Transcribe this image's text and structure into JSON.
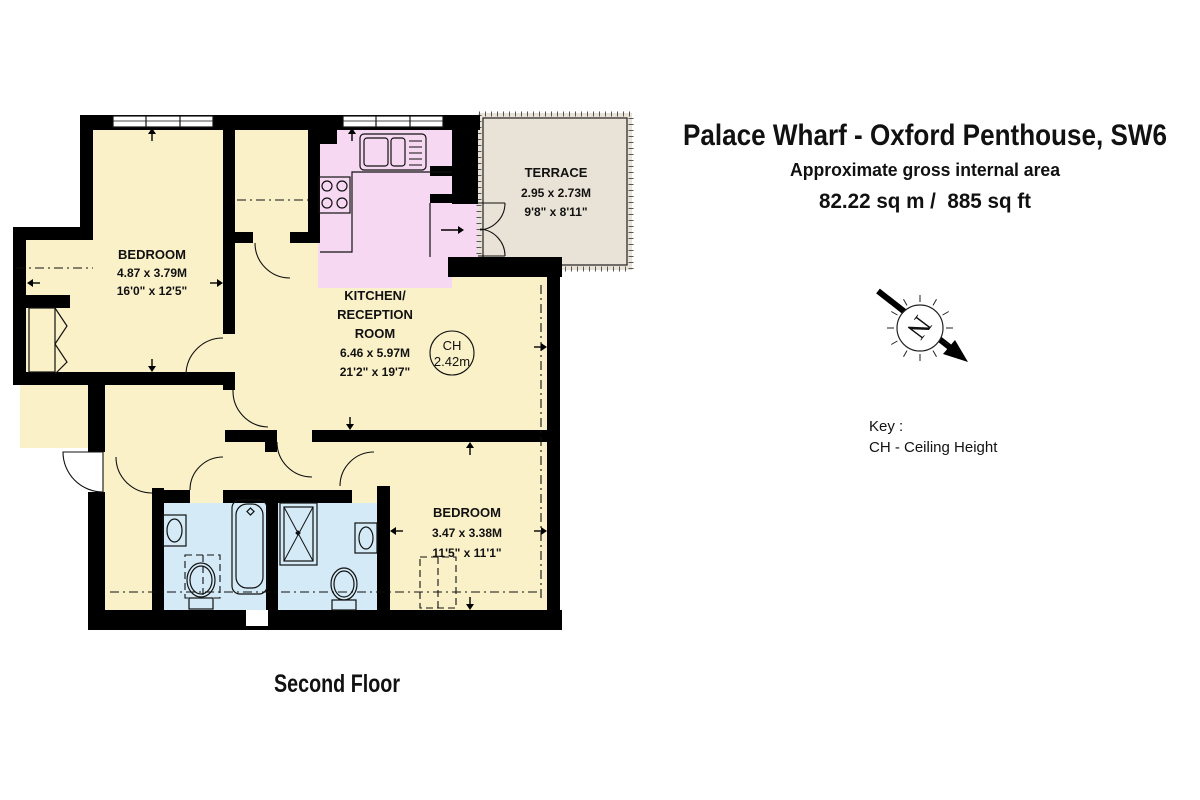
{
  "header": {
    "title": "Palace Wharf - Oxford Penthouse, SW6",
    "subtitle": "Approximate gross internal area",
    "area": "82.22 sq m /  885 sq ft"
  },
  "plan": {
    "floor_label": "Second Floor",
    "rooms": {
      "bedroom1": {
        "name": "BEDROOM",
        "metric": "4.87 x 3.79M",
        "imperial": "16'0\" x 12'5\""
      },
      "kitchen_reception": {
        "line1": "KITCHEN/",
        "line2": "RECEPTION",
        "line3": "ROOM",
        "metric": "6.46 x 5.97M",
        "imperial": "21'2\" x 19'7\""
      },
      "terrace": {
        "name": "TERRACE",
        "metric": "2.95 x 2.73M",
        "imperial": "9'8\" x 8'11\""
      },
      "bedroom2": {
        "name": "BEDROOM",
        "metric": "3.47 x 3.38M",
        "imperial": "11'5\" x 11'1\""
      }
    },
    "ceiling_height": {
      "label": "CH",
      "value": "2.42m"
    }
  },
  "key": {
    "heading": "Key :",
    "item": "CH - Ceiling Height"
  },
  "compass": {
    "letter": "N"
  },
  "colors": {
    "room": "#FBF1C9",
    "kitchen": "#F7D8F2",
    "bathroom": "#D4EBF7",
    "terrace": "#E9E2D6",
    "wall": "#000000"
  }
}
